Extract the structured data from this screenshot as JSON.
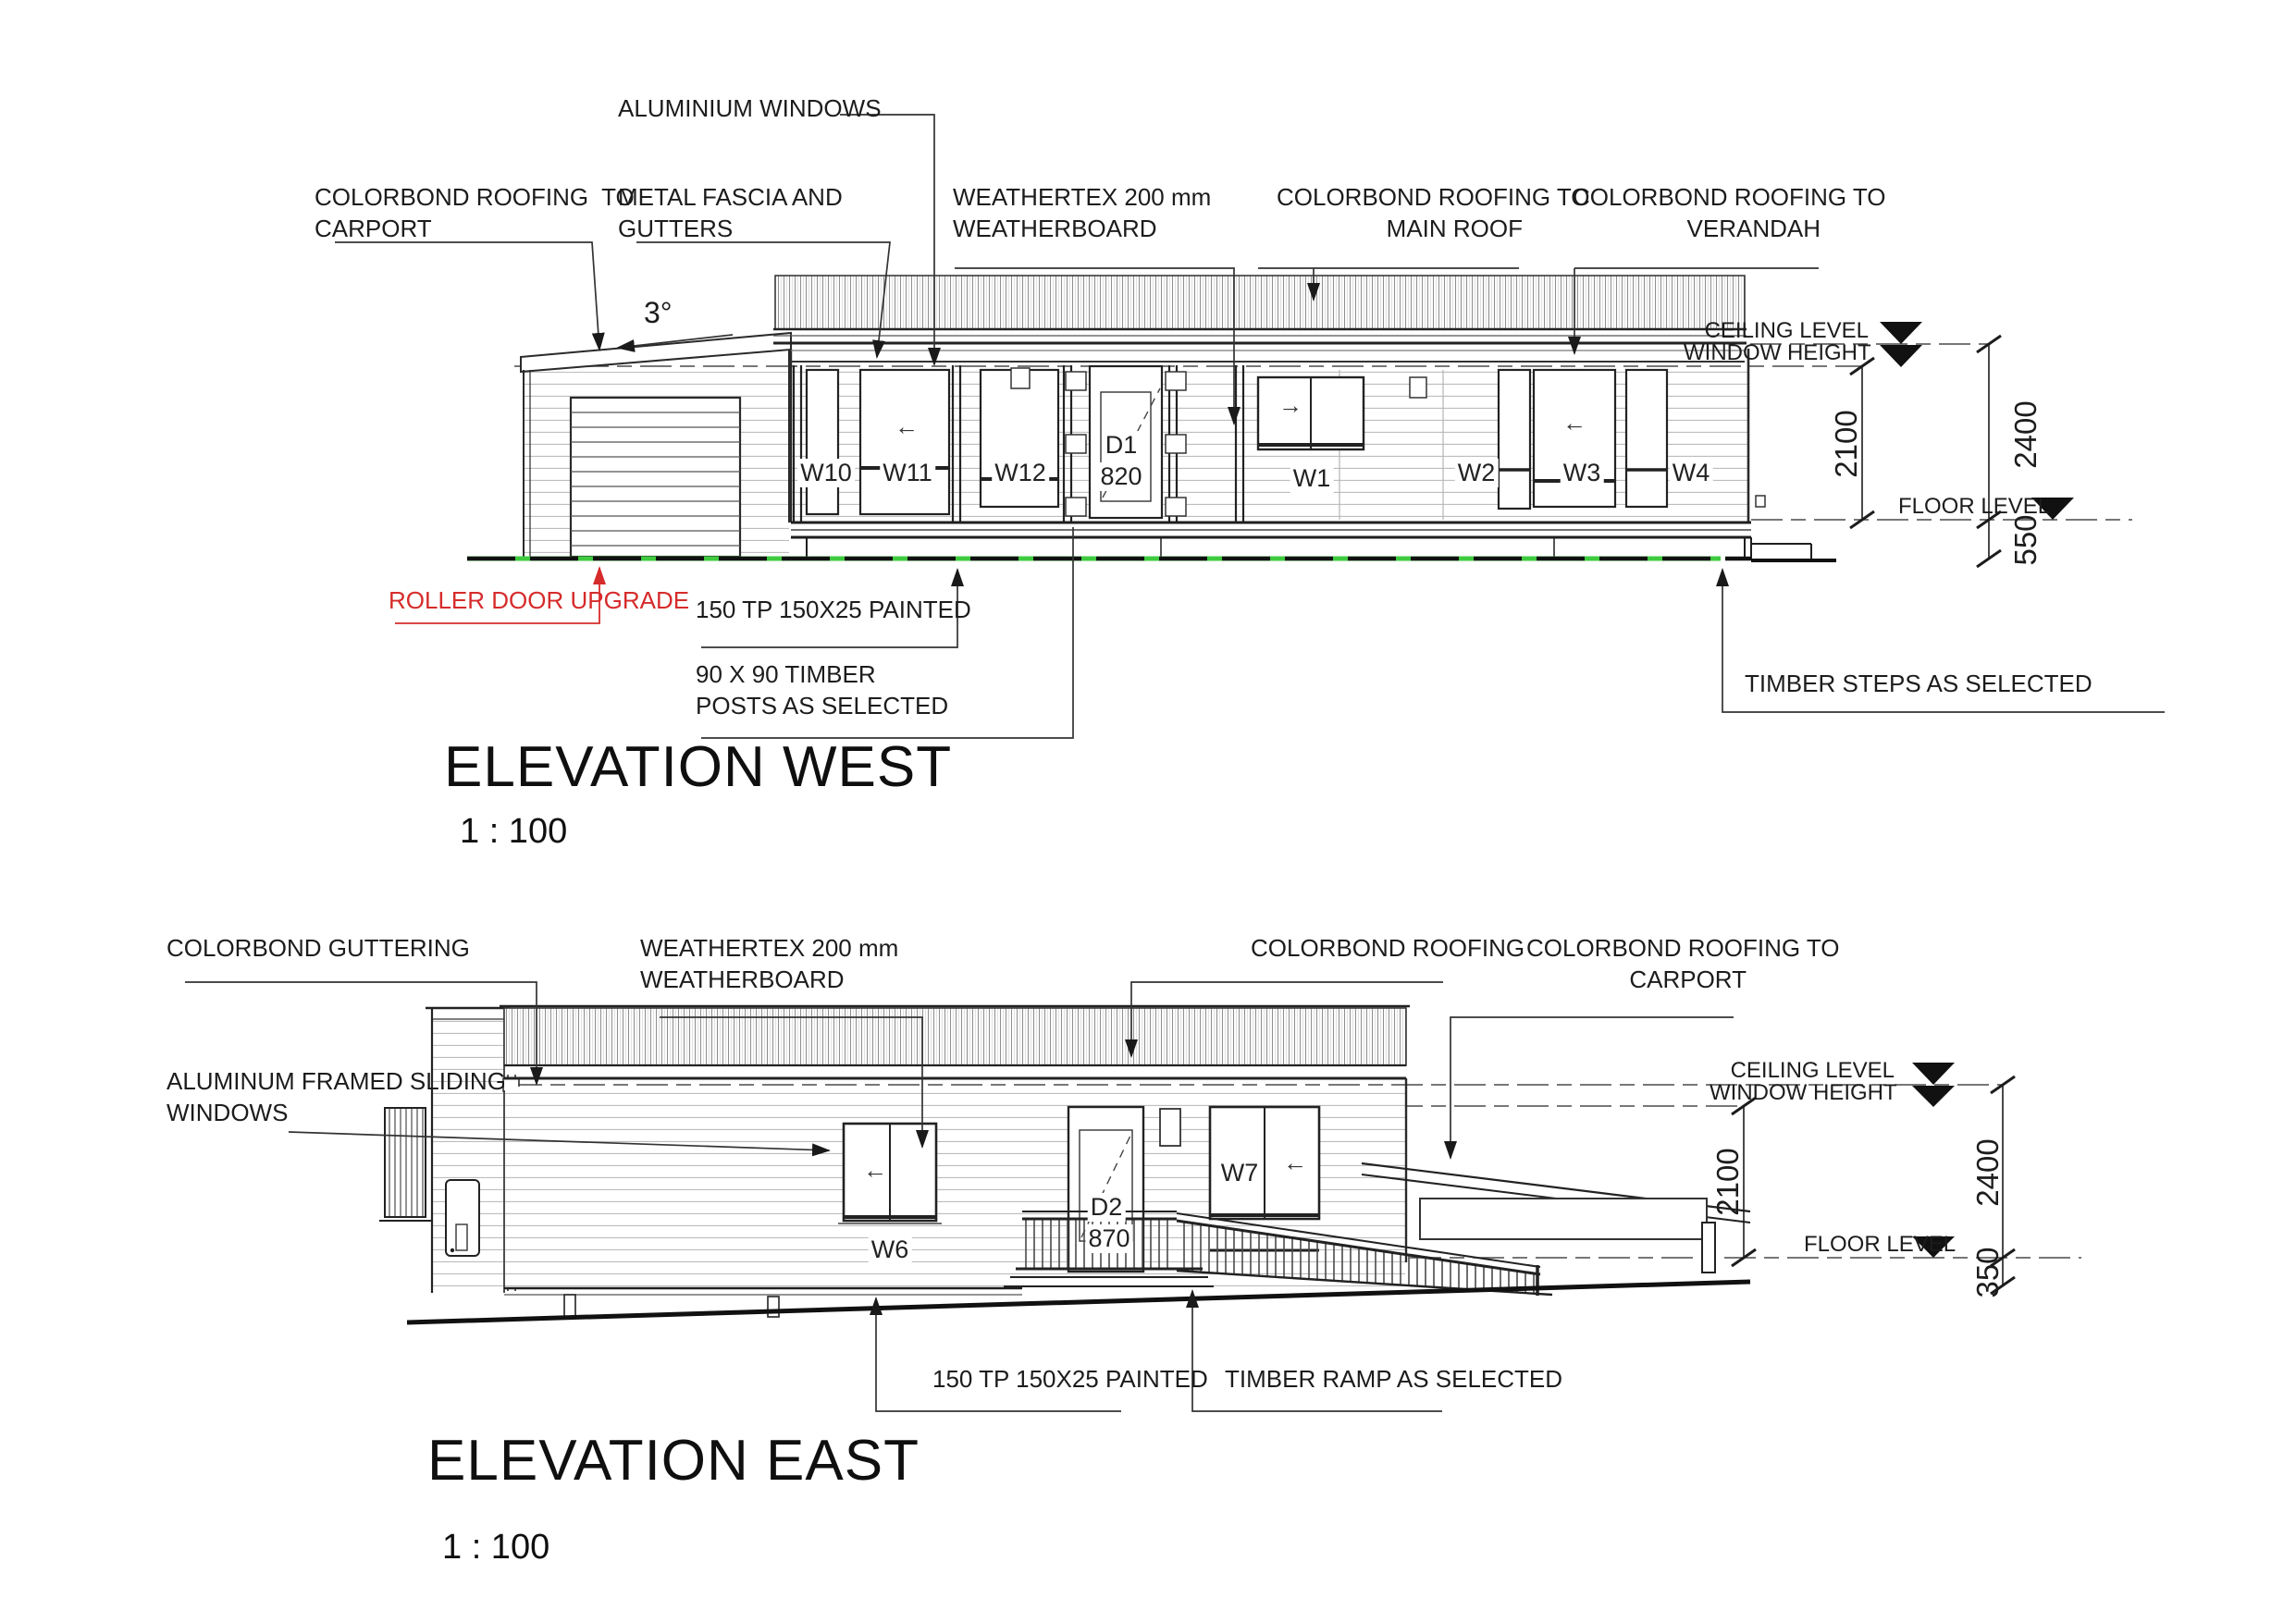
{
  "colors": {
    "ground_green": "#3ecb3e",
    "annotation_red": "#d62b2b",
    "line_dark": "#1a1a1a"
  },
  "west": {
    "title": "ELEVATION WEST",
    "scale": "1 : 100",
    "annotations": {
      "aluminium_windows": "ALUMINIUM WINDOWS",
      "roof_carport_1": "COLORBOND ROOFING  TO",
      "roof_carport_2": "CARPORT",
      "fascia_1": "METAL FASCIA AND",
      "fascia_2": "GUTTERS",
      "weathertex_1": "WEATHERTEX 200 mm",
      "weathertex_2": "WEATHERBOARD",
      "roof_main_1": "COLORBOND ROOFING TO",
      "roof_main_2": "MAIN ROOF",
      "roof_verandah_1": "COLORBOND ROOFING TO",
      "roof_verandah_2": "VERANDAH",
      "pitch": "3°",
      "roller_door": "ROLLER DOOR UPGRADE",
      "tp150": "150 TP 150X25 PAINTED",
      "posts_1": "90 X 90 TIMBER",
      "posts_2": "POSTS AS SELECTED",
      "timber_steps": "TIMBER STEPS AS SELECTED"
    },
    "levels": {
      "ceiling": "CEILING LEVEL",
      "window": "WINDOW HEIGHT",
      "floor": "FLOOR LEVEL"
    },
    "dims": {
      "window_height": "2100",
      "ceiling_height": "2400",
      "subfloor": "550"
    },
    "openings": {
      "w10": "W10",
      "w11": "W11",
      "w12": "W12",
      "w1": "W1",
      "w2": "W2",
      "w3": "W3",
      "w4": "W4",
      "d1": "D1",
      "d1_size": "820",
      "w11_arrow": "←",
      "w1_arrow": "→",
      "w3_arrow": "←"
    }
  },
  "east": {
    "title": "ELEVATION EAST",
    "scale": "1 : 100",
    "annotations": {
      "guttering": "COLORBOND GUTTERING",
      "weathertex_1": "WEATHERTEX 200 mm",
      "weathertex_2": "WEATHERBOARD",
      "roofing": "COLORBOND ROOFING",
      "roof_carport_1": "COLORBOND ROOFING TO",
      "roof_carport_2": "CARPORT",
      "sliding_1": "ALUMINUM FRAMED SLIDING",
      "sliding_2": "WINDOWS",
      "tp150": "150 TP 150X25 PAINTED",
      "ramp": "TIMBER RAMP AS SELECTED"
    },
    "levels": {
      "ceiling": "CEILING LEVEL",
      "window": "WINDOW HEIGHT",
      "floor": "FLOOR LEVEL"
    },
    "dims": {
      "window_height": "2100",
      "ceiling_height": "2400",
      "subfloor": "350"
    },
    "openings": {
      "w6": "W6",
      "w7": "W7",
      "d2": "D2",
      "d2_size": "870",
      "w6_arrow": "←",
      "w7_arrow": "←"
    }
  }
}
